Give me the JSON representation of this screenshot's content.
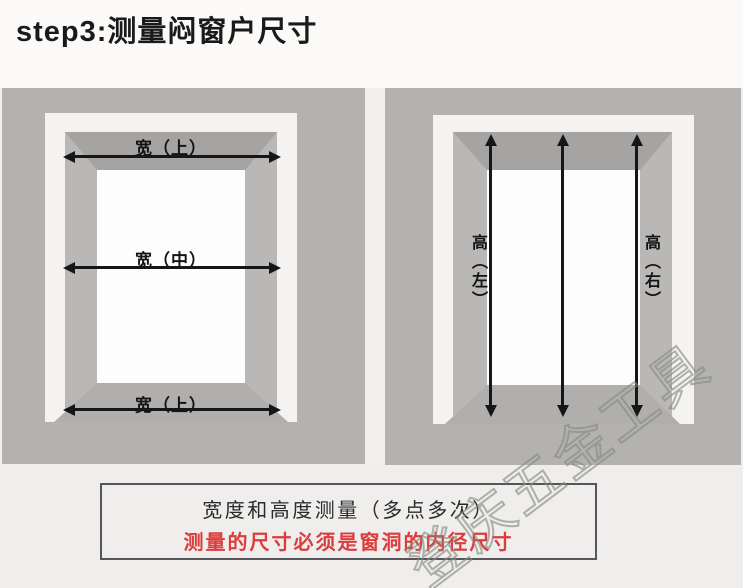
{
  "title": "step3:测量闷窗户尺寸",
  "left_window": {
    "label_top": "宽（上）",
    "label_middle": "宽（中）",
    "label_bottom": "宽（上）"
  },
  "right_window": {
    "label_left": "高（左）",
    "label_right": "高（右）"
  },
  "note_box": {
    "line1": "宽度和高度测量（多点多次）",
    "line2": "测量的尺寸必须是窗洞的内径尺寸"
  },
  "watermark": "登庆五金工具",
  "colors": {
    "accent_red": "#dc3c3c",
    "panel_gray": "#b3b2b0",
    "arrow_black": "#161616"
  }
}
